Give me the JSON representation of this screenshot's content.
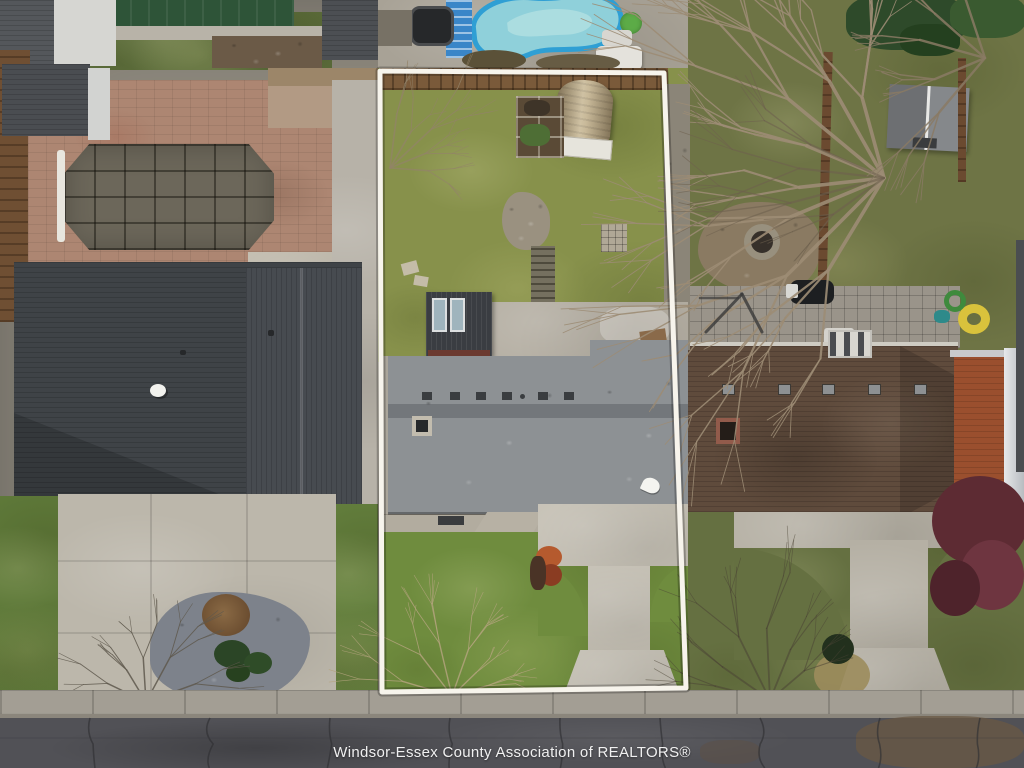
{
  "watermark": {
    "text": "Windsor-Essex County Association of REALTORS®"
  },
  "palette": {
    "road_asphalt": "#515156",
    "sidewalk_concrete": "#a39e94",
    "curb": "#8b867c",
    "driveway_concrete": "#bcb7ab",
    "center_driveway": "#c4bfb3",
    "patio_concrete": "#b4aea2",
    "lot_grass": "#87914b",
    "front_grass": "#6f8c3e",
    "left_front_lawn": "#5f7a3a",
    "right_yard_grass": "#6e7445",
    "right_front_lawn": "#657041",
    "center_roof_gray": "#8d9194",
    "left_roof_charcoal": "#3f4347",
    "right_roof_brown": "#5f4b3c",
    "quonset_tan": "#bfae8c",
    "small_shed_dark": "#3a3d42",
    "pool_water": "#8fd0da",
    "pool_edge": "#2f9fd4",
    "pool_cover_taupe": "#6c675a",
    "green_pool_cover": "#2e5438",
    "brick_patio": "#ad8672",
    "fence_brown": "#6f4f33",
    "gravel_bed": "#7d828b",
    "fire_pit_dirt": "#8a7a62",
    "burgundy_tree": "#5d2b33",
    "outline_white": "#f7f4ec"
  }
}
